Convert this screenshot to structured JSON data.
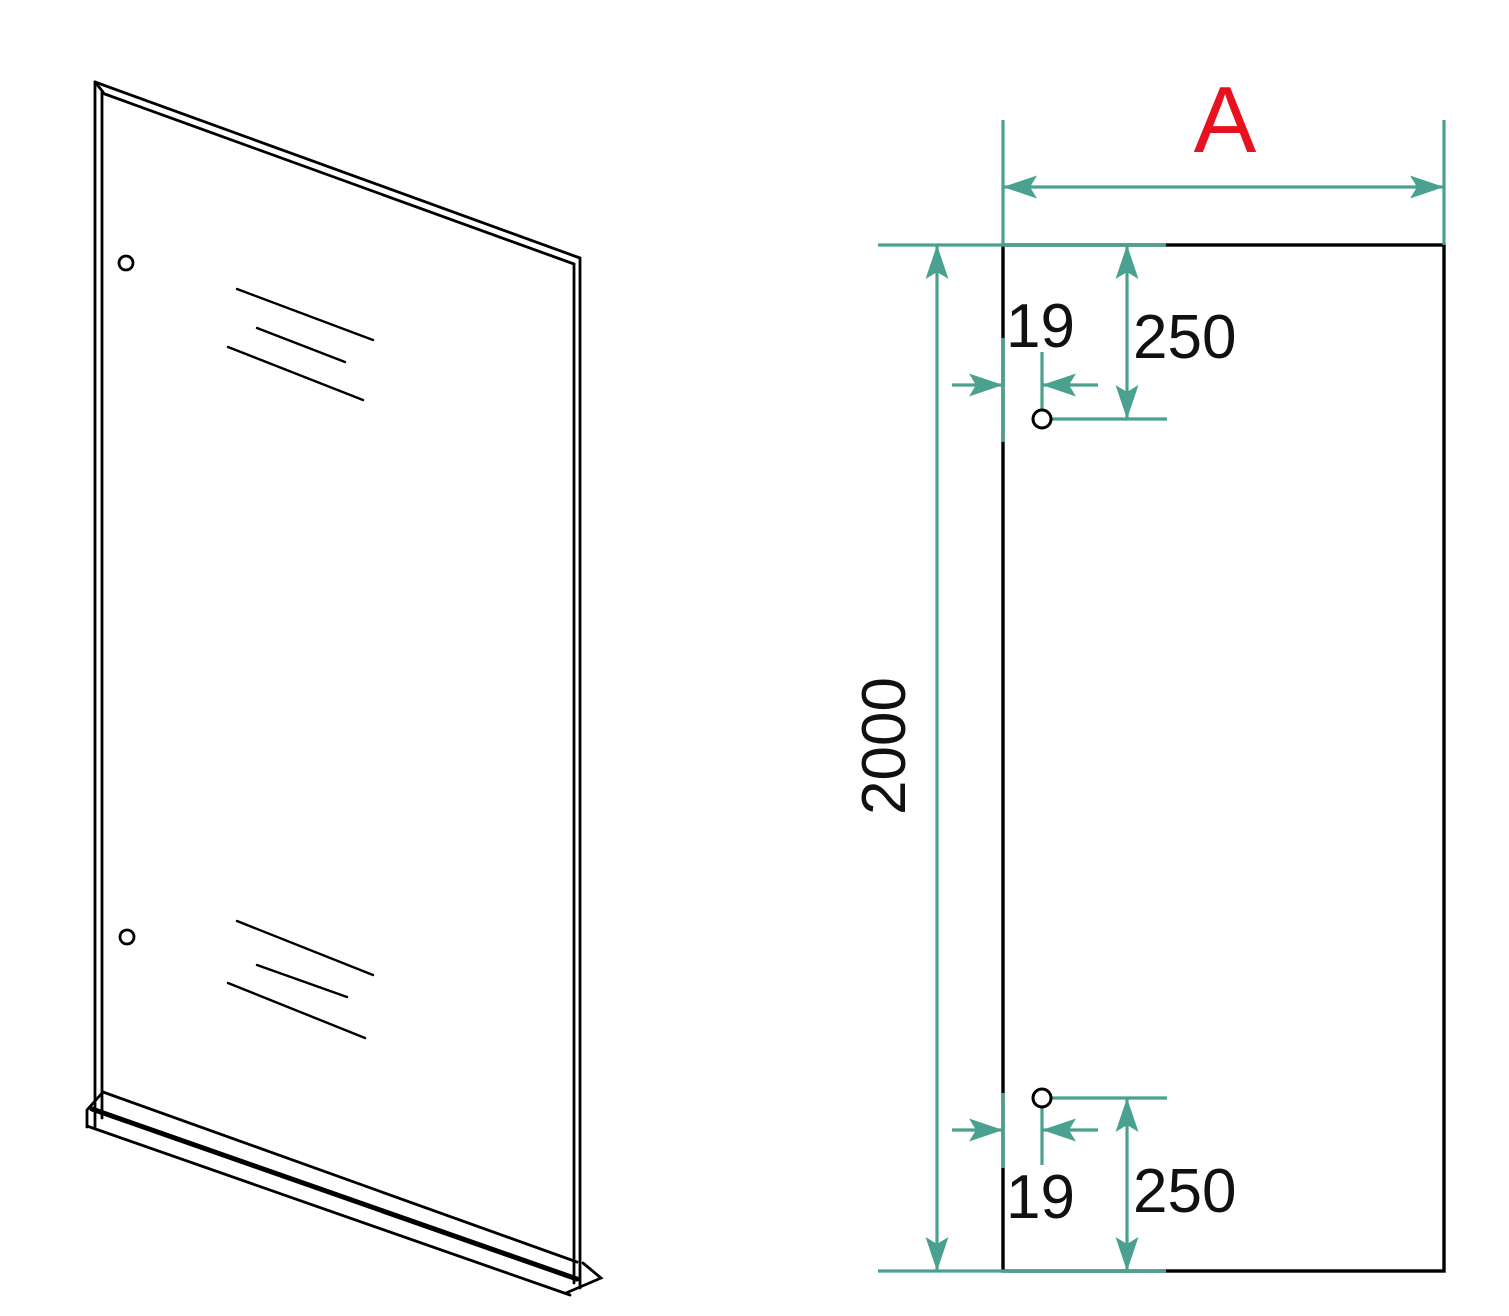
{
  "colors": {
    "dimension_lines": "#4aa18f",
    "drawing_lines": "#000000",
    "width_label_accent": "#e8111f",
    "background": "#ffffff"
  },
  "front_view": {
    "width_dimension": {
      "label": "A"
    },
    "height_dimension": {
      "value": "2000"
    },
    "top_hole": {
      "offset_from_edge": "19",
      "offset_from_top": "250"
    },
    "bottom_hole": {
      "offset_from_edge": "19",
      "offset_from_bottom": "250"
    }
  }
}
